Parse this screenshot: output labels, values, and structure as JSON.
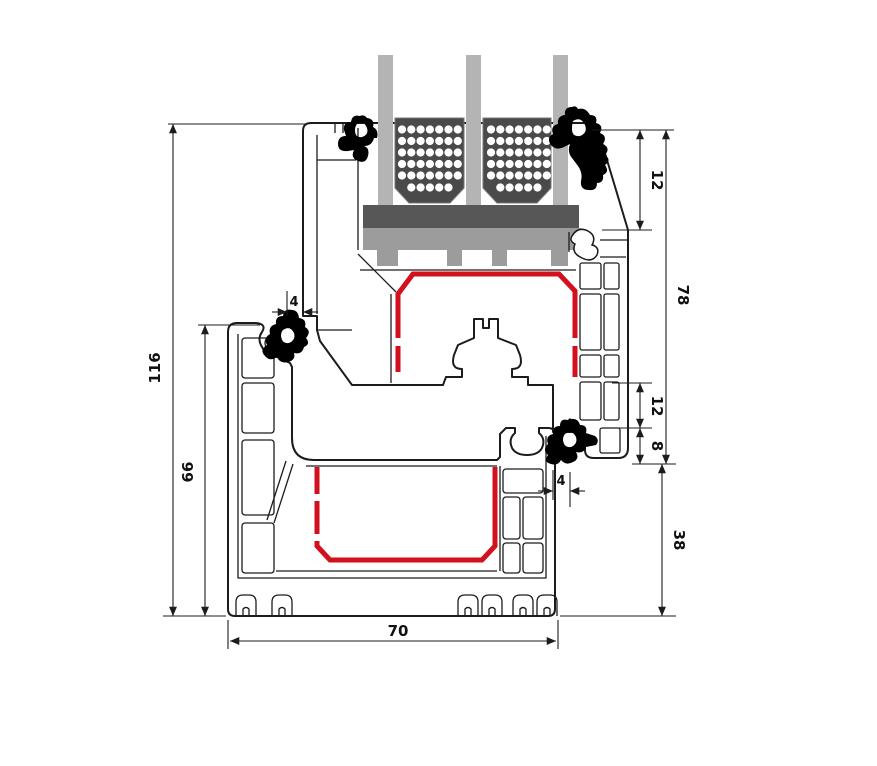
{
  "diagram": {
    "type": "window-profile-cross-section",
    "description": "Technical cross-section of a uPVC window frame and sash with triple glazing, red steel reinforcement, black gaskets and millimetre dimension annotations",
    "dimensions": {
      "overall_height": "116",
      "frame_height": "66",
      "overlap_left": "4",
      "glazing_bead_height": "12",
      "sash_face_height": "78",
      "rebate_step_height": "12",
      "gasket_step_height": "8",
      "overlap_right": "4",
      "frame_exposed_height": "38",
      "profile_depth": "70"
    },
    "glazing": {
      "pane_count": 3,
      "spacer_count": 2,
      "dot_rows": 5,
      "dot_cols": 7,
      "bottom_dot_count": 5
    },
    "colors": {
      "outline": "#1c1c1c",
      "steel_reinforcement": "#d2101e",
      "glass": "#b4b4b4",
      "spacer": "#4a4a4a",
      "glazing_block": "#575757",
      "glazing_bridge": "#9c9c9c",
      "gasket": "#000000",
      "profile": "#ffffff",
      "dimension_lines": "#1c1c1c"
    }
  }
}
